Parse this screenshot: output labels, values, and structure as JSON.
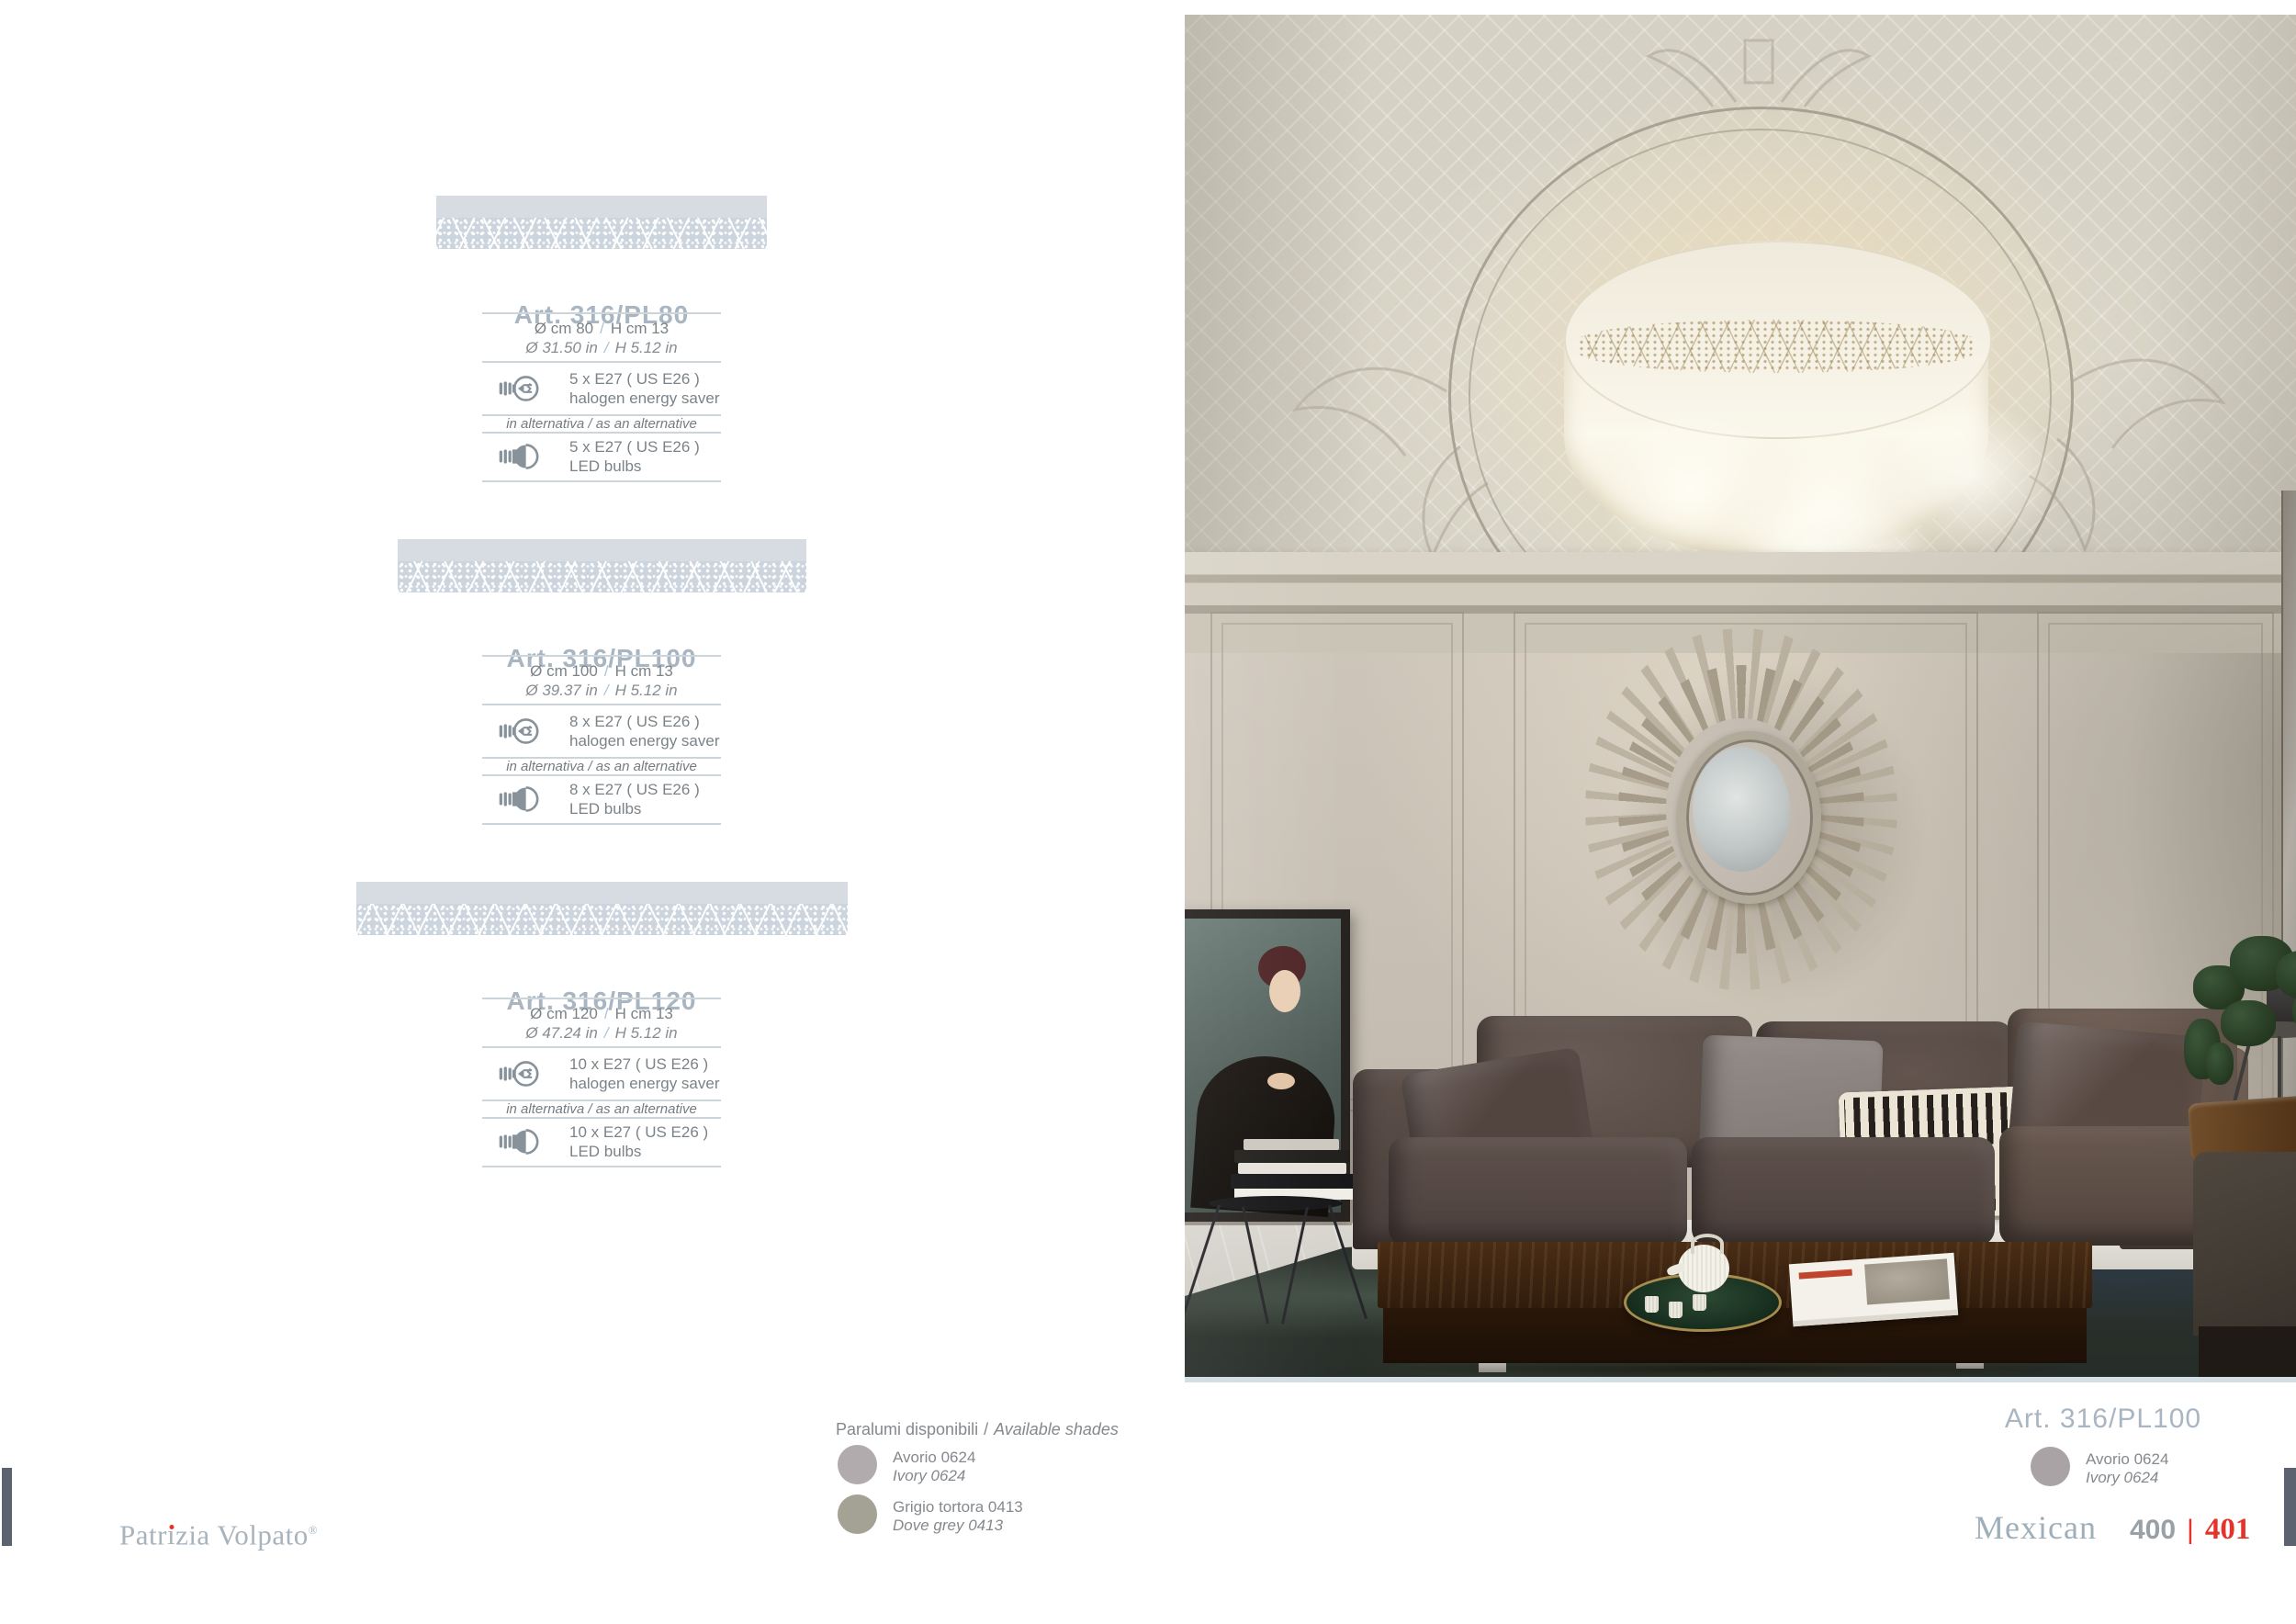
{
  "common": {
    "slash": "/"
  },
  "colors": {
    "accent_red": "#e5322b",
    "title_blue_grey": "#a9b6c2",
    "spec_text_grey": "#7b8388",
    "band_fill": "#d3dae2",
    "hairline": "#ccd5da",
    "swatch_ivory": "#b2abae",
    "swatch_dove_grey": "#a4a295",
    "page_tab": "#5b6270"
  },
  "icons": {
    "halogen": "halogen-energy-saver-bulb",
    "led": "led-bulb"
  },
  "products": [
    {
      "art": "Art. 316/PL80",
      "d_cm": "Ø cm 80",
      "h_cm": "H cm 13",
      "d_in": "Ø 31.50 in",
      "h_in": "H 5.12 in",
      "halogen_qty": "5 x E27 ( US E26 )",
      "halogen_label": "halogen energy saver",
      "alternative": "in alternativa / as an alternative",
      "led_qty": "5 x E27 ( US E26 )",
      "led_label": "LED bulbs"
    },
    {
      "art": "Art. 316/PL100",
      "d_cm": "Ø cm 100",
      "h_cm": "H cm 13",
      "d_in": "Ø 39.37 in",
      "h_in": "H 5.12 in",
      "halogen_qty": "8 x E27 ( US E26 )",
      "halogen_label": "halogen energy saver",
      "alternative": "in alternativa / as an alternative",
      "led_qty": "8 x E27 ( US E26 )",
      "led_label": "LED bulbs"
    },
    {
      "art": "Art. 316/PL120",
      "d_cm": "Ø cm 120",
      "h_cm": "H cm 13",
      "d_in": "Ø 47.24 in",
      "h_in": "H 5.12 in",
      "halogen_qty": "10 x E27 ( US E26 )",
      "halogen_label": "halogen energy saver",
      "alternative": "in alternativa / as an alternative",
      "led_qty": "10 x E27 ( US E26 )",
      "led_label": "LED bulbs"
    }
  ],
  "shades": {
    "heading_it": "Paralumi disponibili",
    "heading_en": "Available shades",
    "items": [
      {
        "name_it": "Avorio 0624",
        "name_en": "Ivory 0624",
        "color": "#b2abae"
      },
      {
        "name_it": "Grigio tortora 0413",
        "name_en": "Dove grey 0413",
        "color": "#a4a295"
      }
    ]
  },
  "photo_caption": {
    "art": "Art. 316/PL100",
    "shade": {
      "name_it": "Avorio 0624",
      "name_en": "Ivory 0624",
      "color": "#aaa3a6"
    }
  },
  "footer": {
    "brand_pre": "Patr",
    "brand_i": "ı",
    "brand_rest": "zia Volpato",
    "registered": "®",
    "collection": "Mexican",
    "page_left": "400",
    "page_sep": "|",
    "page_right": "401"
  }
}
